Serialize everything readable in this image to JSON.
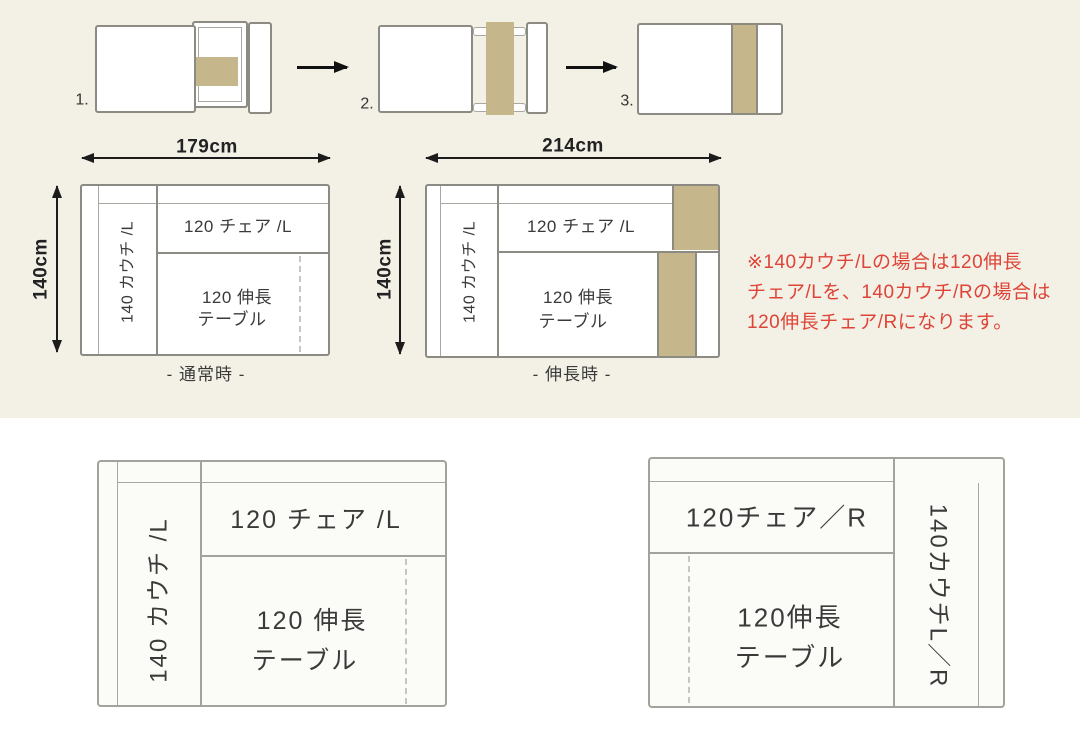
{
  "colors": {
    "background_top": "#f3f0e6",
    "background_bottom": "#ffffff",
    "tan": "#c5b68c",
    "line_dark": "#8b8b83",
    "line_mid": "#a8a8a0",
    "line_light": "#a3a39d",
    "text": "#3a3a3a",
    "note_red": "#df4438"
  },
  "steps": {
    "labels": [
      "1.",
      "2.",
      "3."
    ]
  },
  "diagrams": {
    "normal": {
      "width": "179cm",
      "height": "140cm",
      "couch": "140 カウチ /L",
      "chair": "120 チェア /L",
      "table_line1": "120 伸長",
      "table_line2": "テーブル",
      "caption": "- 通常時 -"
    },
    "extended": {
      "width": "214cm",
      "height": "140cm",
      "couch": "140 カウチ /L",
      "chair": "120 チェア /L",
      "table_line1": "120 伸長",
      "table_line2": "テーブル",
      "caption": "- 伸長時 -"
    },
    "layout_left": {
      "couch": "140 カウチ /L",
      "chair": "120 チェア /L",
      "table_line1": "120 伸長",
      "table_line2": "テーブル"
    },
    "layout_right": {
      "couch": "140カウチL／R",
      "chair": "120チェア／R",
      "table_line1": "120伸長",
      "table_line2": "テーブル"
    }
  },
  "note": {
    "line1": "※140カウチ/Lの場合は120伸長",
    "line2": "チェア/Lを、140カウチ/Rの場合は",
    "line3": "120伸長チェア/Rになります。"
  }
}
